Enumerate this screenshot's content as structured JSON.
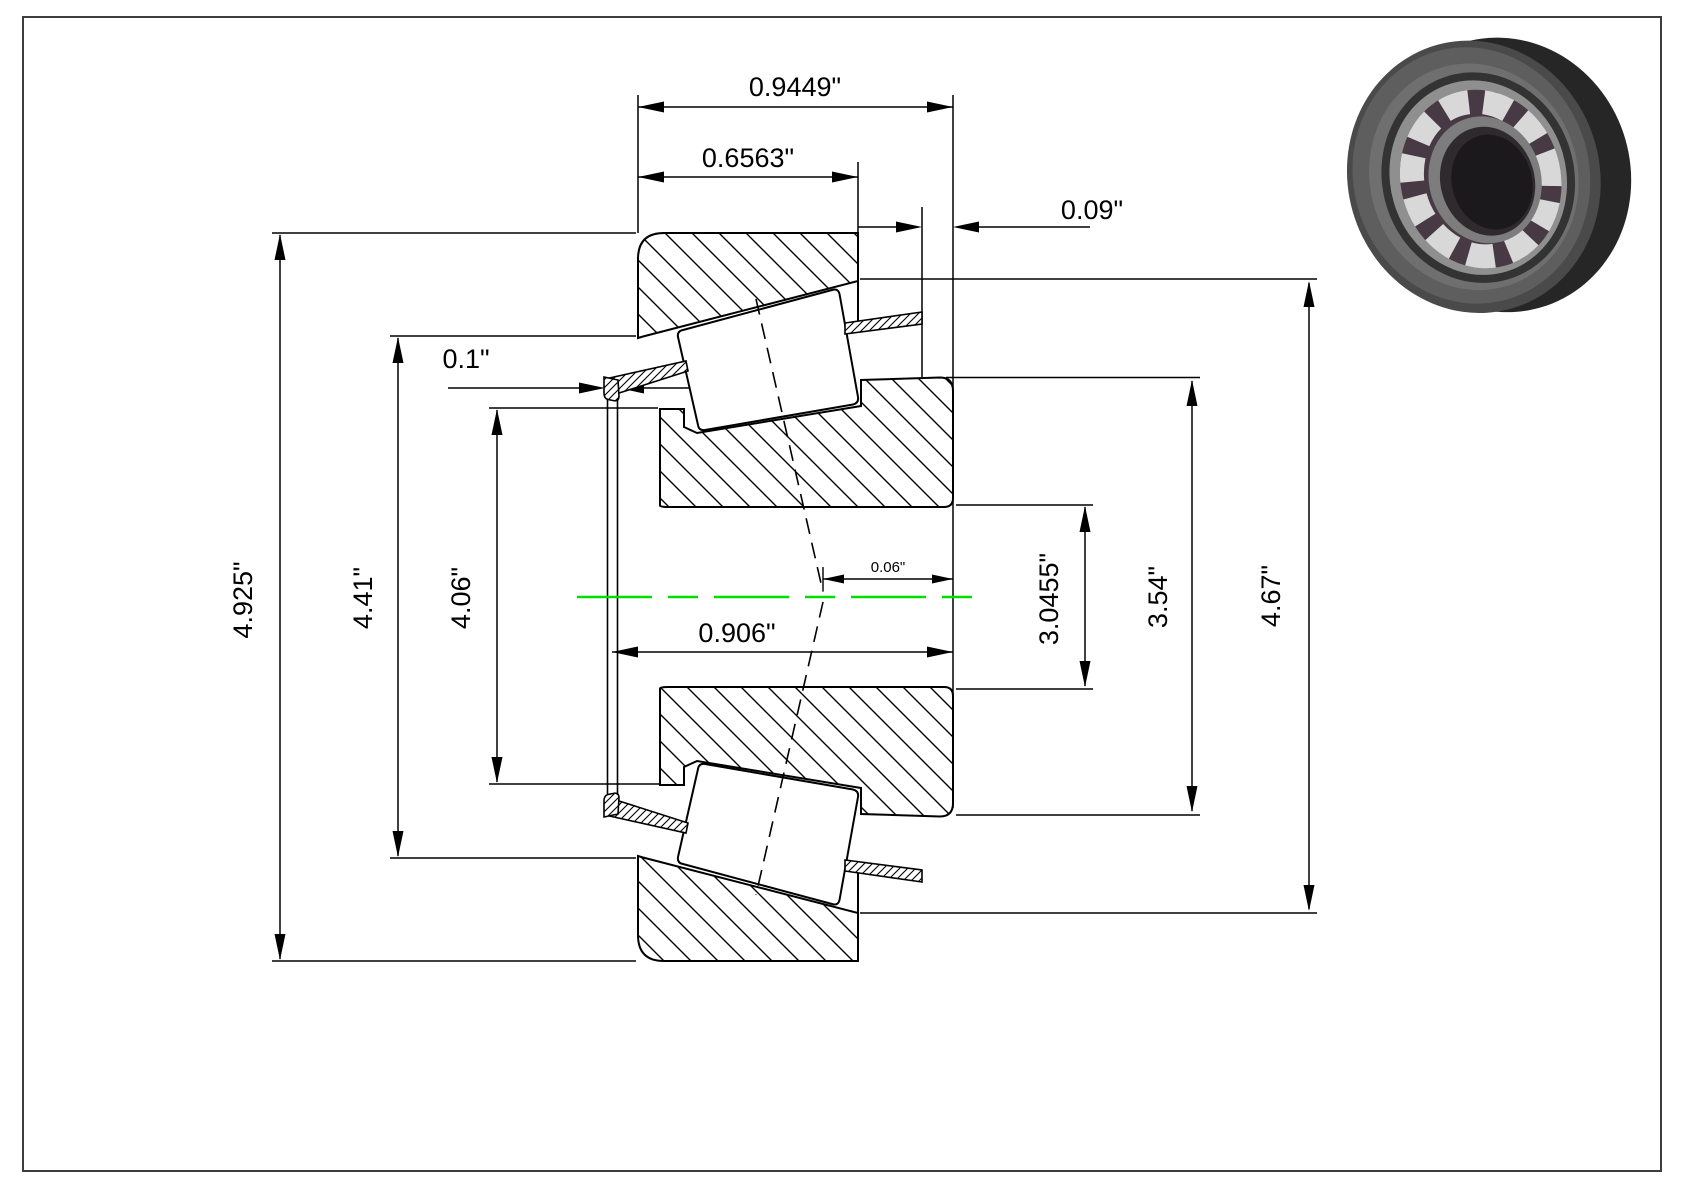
{
  "page": {
    "background": "#ffffff",
    "border_color": "#3d3d3d"
  },
  "drawing": {
    "type": "tapered-roller-bearing-cross-section",
    "centerline_color": "#00dd00",
    "line_color": "#000000",
    "labels": {
      "total_width": "0.9449\"",
      "cup_width": "0.6563\"",
      "back_clearance": "0.09\"",
      "cage_lip": "0.1\"",
      "cone_width": "0.906\"",
      "effective_center": "0.06\"",
      "od_outer": "4.925\"",
      "cage_od": "4.41\"",
      "cage_id": "4.06\"",
      "bore": "3.0455\"",
      "rib_od": "3.54\"",
      "cup_od": "4.67\""
    }
  },
  "photo": {
    "description": "tapered roller bearing 3d render"
  }
}
